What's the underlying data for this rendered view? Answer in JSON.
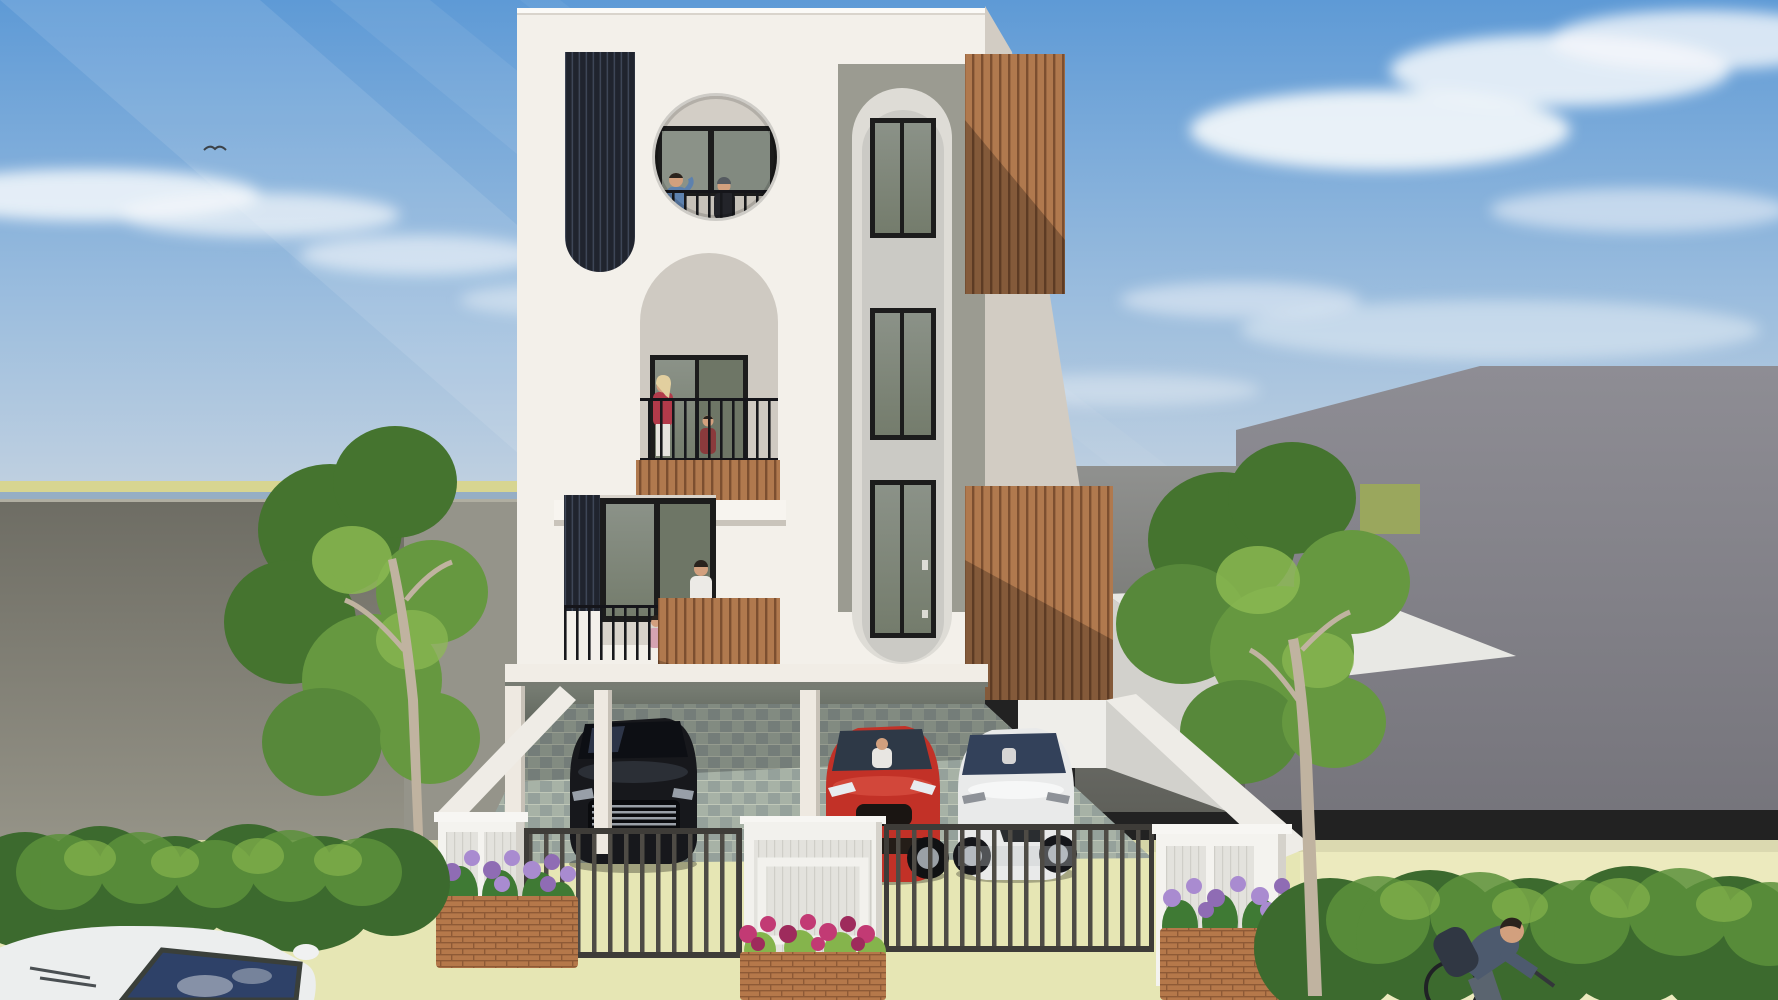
{
  "scene": {
    "description": "3D architectural exterior render of a modern three-storey white residence with wooden slat screens, circular and arched balcony openings with residents, a ground-floor carport holding a black, a red and a white car behind metal gates, flanked by grey neighbouring walls, trees, hedges, flower planters, a foreground parked car and a passing cyclist under a blue morning sky.",
    "colors": {
      "sky_top": "#5e9ad6",
      "sky_mid": "#9dbede",
      "sky_low": "#cdd7e1",
      "cloud": "#f5f8fb",
      "field": "#d7d591",
      "sea": "#95aec5",
      "left_wall": "#6e6d64",
      "left_wall_light": "#95948a",
      "right_wall_top": "#90918f",
      "right_wall_bottom": "#5f605a",
      "far_building_top": "#8e8d94",
      "far_building_bottom": "#76757c",
      "grass": "#9aa75d",
      "grass_bright": "#8aa04e",
      "white_bright": "#f3f0ea",
      "white_shade": "#ddd8d0",
      "side_shade": "#d2ccc3",
      "panel_gray": "#9b9b91",
      "recess_light": "#dedcd6",
      "strip_light": "#cbcac5",
      "wood": "#b0794e",
      "wood_dark": "#7c4f30",
      "dark_slat_bg": "#20242e",
      "dark_slat_line": "#3e4657",
      "glass": "#747c6c",
      "glass_light": "#8b9288",
      "frame": "#1c1c1c",
      "railing": "#17181c",
      "carport_top": "#777d73",
      "carport_bottom": "#31352f",
      "tile_a": "#a7b2a6",
      "tile_b": "#95a19b",
      "road": "#e6e6b4",
      "road_bright": "#efecc3",
      "gate_bar": "#4e4b45",
      "gate_frame": "#3e3c38",
      "pillar": "#f4f3ef",
      "pillar_panel": "#e3e2dd",
      "brick": "#b5784a",
      "brick_line": "#8e5a36",
      "flower_pink": "#c23a74",
      "flower_purple": "#a98bd0",
      "flower_purple_dark": "#8f6cb4",
      "leaf": "#3f7a34",
      "bush_dark": "#3c6a2e",
      "bush_mid": "#5c913b",
      "bush_light": "#85b44c",
      "tree_dark": "#45742f",
      "tree_mid": "#669840",
      "tree_light": "#8dbb52",
      "trunk": "#c0b3a0",
      "car_black": "#17181c",
      "car_black_hi": "#3f4550",
      "car_red": "#c23127",
      "car_red_dark": "#871d16",
      "car_white": "#e9eaea",
      "windshield": "#2e3947",
      "glass_blue": "#2e4168",
      "chrome": "#9aa0a8",
      "skin": "#d2a07e",
      "hair_dark": "#2a231d",
      "shirt_blue": "#5d81ae",
      "shirt_black": "#23242a",
      "top_red": "#b23a4a",
      "pants_white": "#e6e3de",
      "hair_blonde": "#e2cf9f",
      "shirt_white": "#eceae6",
      "child_pink": "#d5a3b2",
      "child_red": "#8a3a3c",
      "cyclist_top": "#4d5a6e",
      "backpack": "#303743"
    }
  }
}
